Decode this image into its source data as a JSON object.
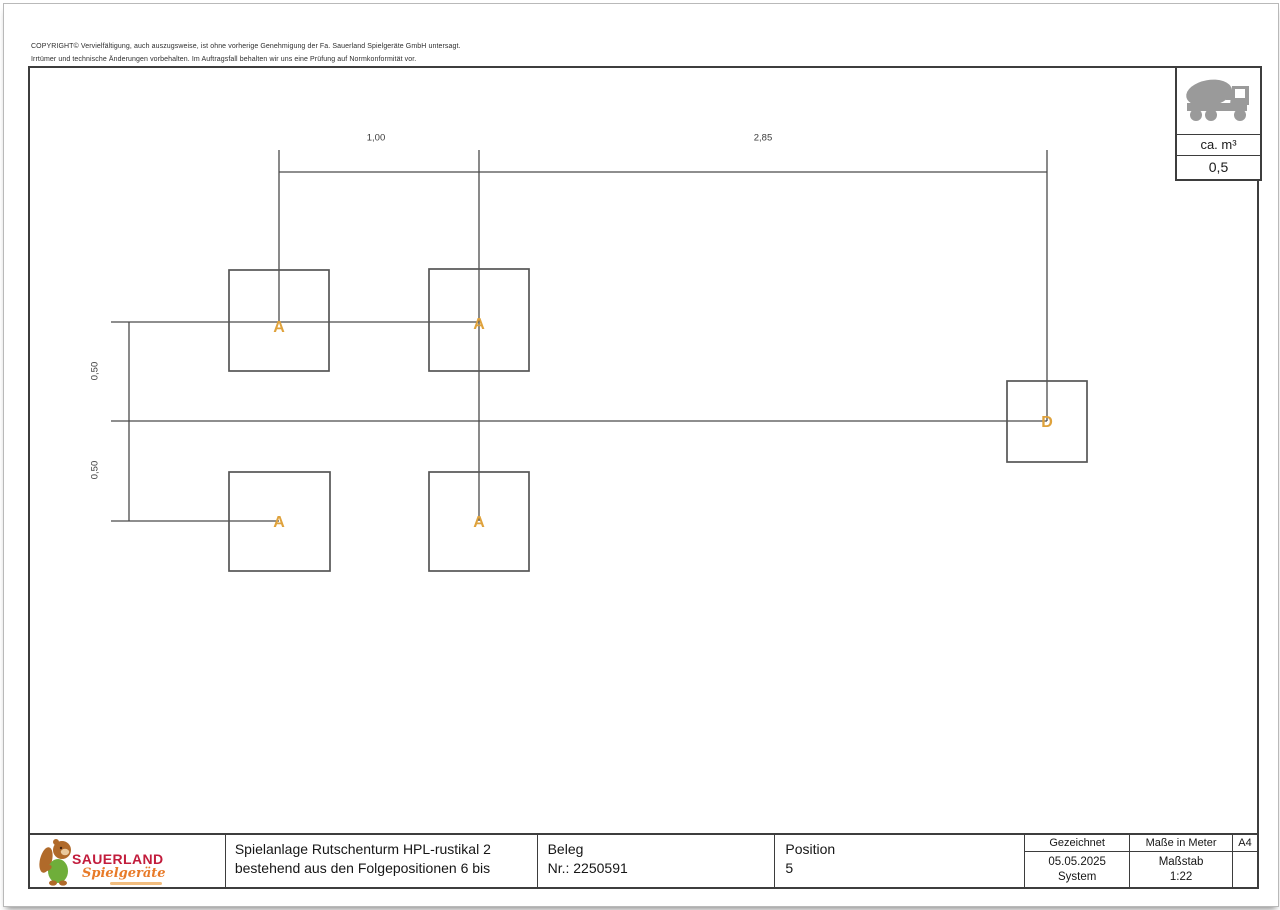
{
  "copyright": {
    "line1": "COPYRIGHT© Vervielfältigung, auch auszugsweise, ist ohne vorherige Genehmigung der Fa. Sauerland Spielgeräte GmbH untersagt.",
    "line2": "Irrtümer und technische Änderungen vorbehalten. Im Auftragsfall behalten wir uns eine Prüfung auf Normkonformität vor."
  },
  "concrete": {
    "icon": "concrete-mixer-truck",
    "label": "ca. m³",
    "value": "0,5"
  },
  "plan": {
    "accent_color": "#DFA23C",
    "line_color": "#4a4a4a",
    "dim_top": [
      {
        "label": "1,00"
      },
      {
        "label": "2,85"
      }
    ],
    "dim_left": [
      {
        "label": "0,50"
      },
      {
        "label": "0,50"
      }
    ],
    "foundations": [
      {
        "label": "A"
      },
      {
        "label": "A"
      },
      {
        "label": "A"
      },
      {
        "label": "A"
      },
      {
        "label": "D"
      }
    ]
  },
  "title_block": {
    "logo_name": "SAUERLAND",
    "logo_sub": "Spielgeräte",
    "title_line1": "Spielanlage Rutschenturm HPL-rustikal 2",
    "title_line2": "bestehend aus den Folgepositionen 6 bis",
    "beleg_label": "Beleg",
    "beleg_value": "Nr.: 2250591",
    "position_label": "Position",
    "position_value": "5",
    "drawn_header": "Gezeichnet",
    "drawn_date": "05.05.2025",
    "drawn_by": "System",
    "units_header": "Maße in Meter",
    "scale_label": "Maßstab",
    "scale_value": "1:22",
    "format": "A4"
  }
}
